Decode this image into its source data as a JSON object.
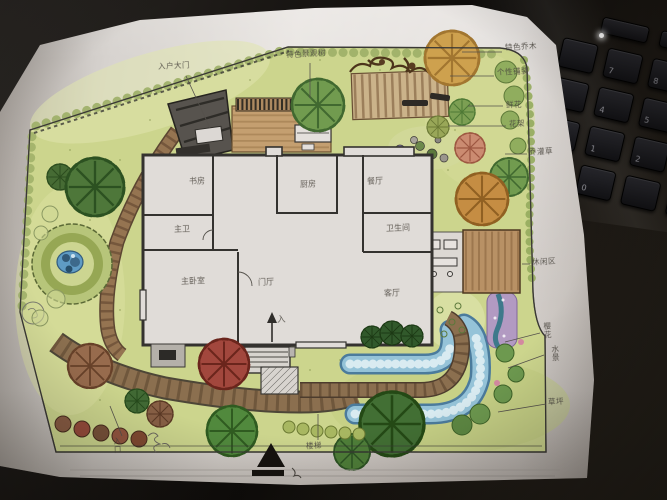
{
  "plan": {
    "rooms": [
      {
        "label": "书房"
      },
      {
        "label": "主卫"
      },
      {
        "label": "厨房"
      },
      {
        "label": "餐厅"
      },
      {
        "label": "卫生间"
      },
      {
        "label": "主卧室"
      },
      {
        "label": "门厅"
      },
      {
        "label": "客厅"
      }
    ],
    "annotations": [
      {
        "text": "入户大门"
      },
      {
        "text": "特色景观树"
      },
      {
        "text": "特色乔木"
      },
      {
        "text": "个性铺装"
      },
      {
        "text": "鲜花"
      },
      {
        "text": "花架"
      },
      {
        "text": "乔灌草"
      },
      {
        "text": "休闲区"
      },
      {
        "text": "樱花"
      },
      {
        "text": "水景"
      },
      {
        "text": "草坪"
      },
      {
        "text": "入口"
      },
      {
        "text": "楼梯"
      },
      {
        "text": "入"
      }
    ]
  },
  "keyboard": {
    "keys": [
      "7",
      "8",
      "9",
      "4",
      "5",
      "6",
      "1",
      "2",
      "3",
      "0"
    ]
  },
  "colors": {
    "lawn": "#ccd687",
    "tree_green": "#4e7a38",
    "path_brown": "#8a6848",
    "water_blue": "#8fc0d6",
    "deck_tan": "#c59a68",
    "accent_orange": "#cf9140",
    "accent_red": "#a8453a",
    "purple_feature": "#b193cc",
    "ink": "#3a3835",
    "paper": "#e2dedb",
    "desk": "#14110e"
  }
}
